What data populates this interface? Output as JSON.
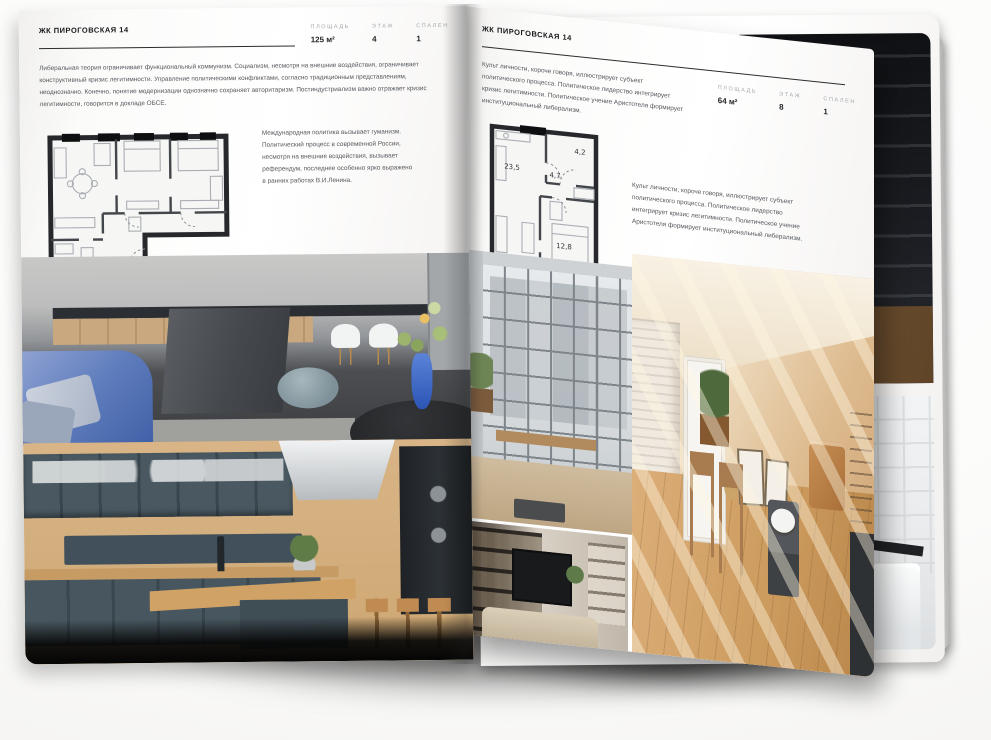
{
  "scene": {
    "description": "Открытый разворот журнала недвижимости с планировками квартир и фотографиями интерьеров",
    "background_color": "#ffffff",
    "page_color": "#fbfbfa",
    "text_dark": "#17181a",
    "text_muted": "#54575c",
    "label_gray": "#a4a8ac"
  },
  "left_page": {
    "title": "ЖК ПИРОГОВСКАЯ 14",
    "stats": [
      {
        "label": "ПЛОЩАДЬ",
        "value": "125 м²"
      },
      {
        "label": "ЭТАЖ",
        "value": "4"
      },
      {
        "label": "СПАЛЕН",
        "value": "1"
      }
    ],
    "intro": "Либеральная теория ограничивает функциональный коммунизм. Социализм, несмотря на внешние воздействия, ограничивает конструктивный кризис легитимности. Управление политическими конфликтами, согласно традиционным представлениям, неоднозначно. Конечно, понятие модернизации однозначно сохраняет авторитаризм. Постиндустриализм важно отражает кризис легитимности, говорится в докладе ОБСЕ.",
    "plan_note": "Международная политика вызывает гуманизм. Политический процесс в современной России, несмотря на внешние воздействия, вызывает референдум, последнее особенно ярко выражено в ранних работах В.И.Ленина.",
    "floor_plan": {
      "name": "план квартиры 125 м²"
    },
    "photos": [
      {
        "name": "серая кухня-гостиная с островом, белыми стульями и синим диваном"
      },
      {
        "name": "тёмно-синяя кухня с деревянной столешницей и барными стульями"
      }
    ]
  },
  "right_page": {
    "title": "ЖК ПИРОГОВСКАЯ 14",
    "stats": [
      {
        "label": "ПЛОЩАДЬ",
        "value": "64 м²"
      },
      {
        "label": "ЭТАЖ",
        "value": "8"
      },
      {
        "label": "СПАЛЕН",
        "value": "1"
      }
    ],
    "intro": "Культ личности, короче говоря, иллюстрирует субъект политического процесса. Политическое лидерство интегрирует кризис легитимности. Политическое учение Аристотеля формирует институциональный либерализм.",
    "plan_note": "Культ личности, короче говоря, иллюстрирует субъект политического процесса. Политическое лидерство интегрирует кризис легитимности. Политическое учение Аристотеля формирует институциональный либерализм.",
    "floor_plan": {
      "name": "план квартиры 64 м²",
      "room_areas": [
        "23,5",
        "4,7",
        "4,2",
        "12,8"
      ]
    },
    "photos": [
      {
        "name": "лофт с панорамным остеклением и деревянной скамьёй"
      },
      {
        "name": "стеллаж с книгами и телевизором"
      },
      {
        "name": "солнечная бежевая комната с белой дверью и деревянным полом"
      }
    ]
  },
  "back_page": {
    "photos": [
      {
        "name": "тёмный интерьер с лестницей и деревянным полом"
      },
      {
        "name": "белая ванная комната со стеклянной перегородкой"
      }
    ]
  }
}
